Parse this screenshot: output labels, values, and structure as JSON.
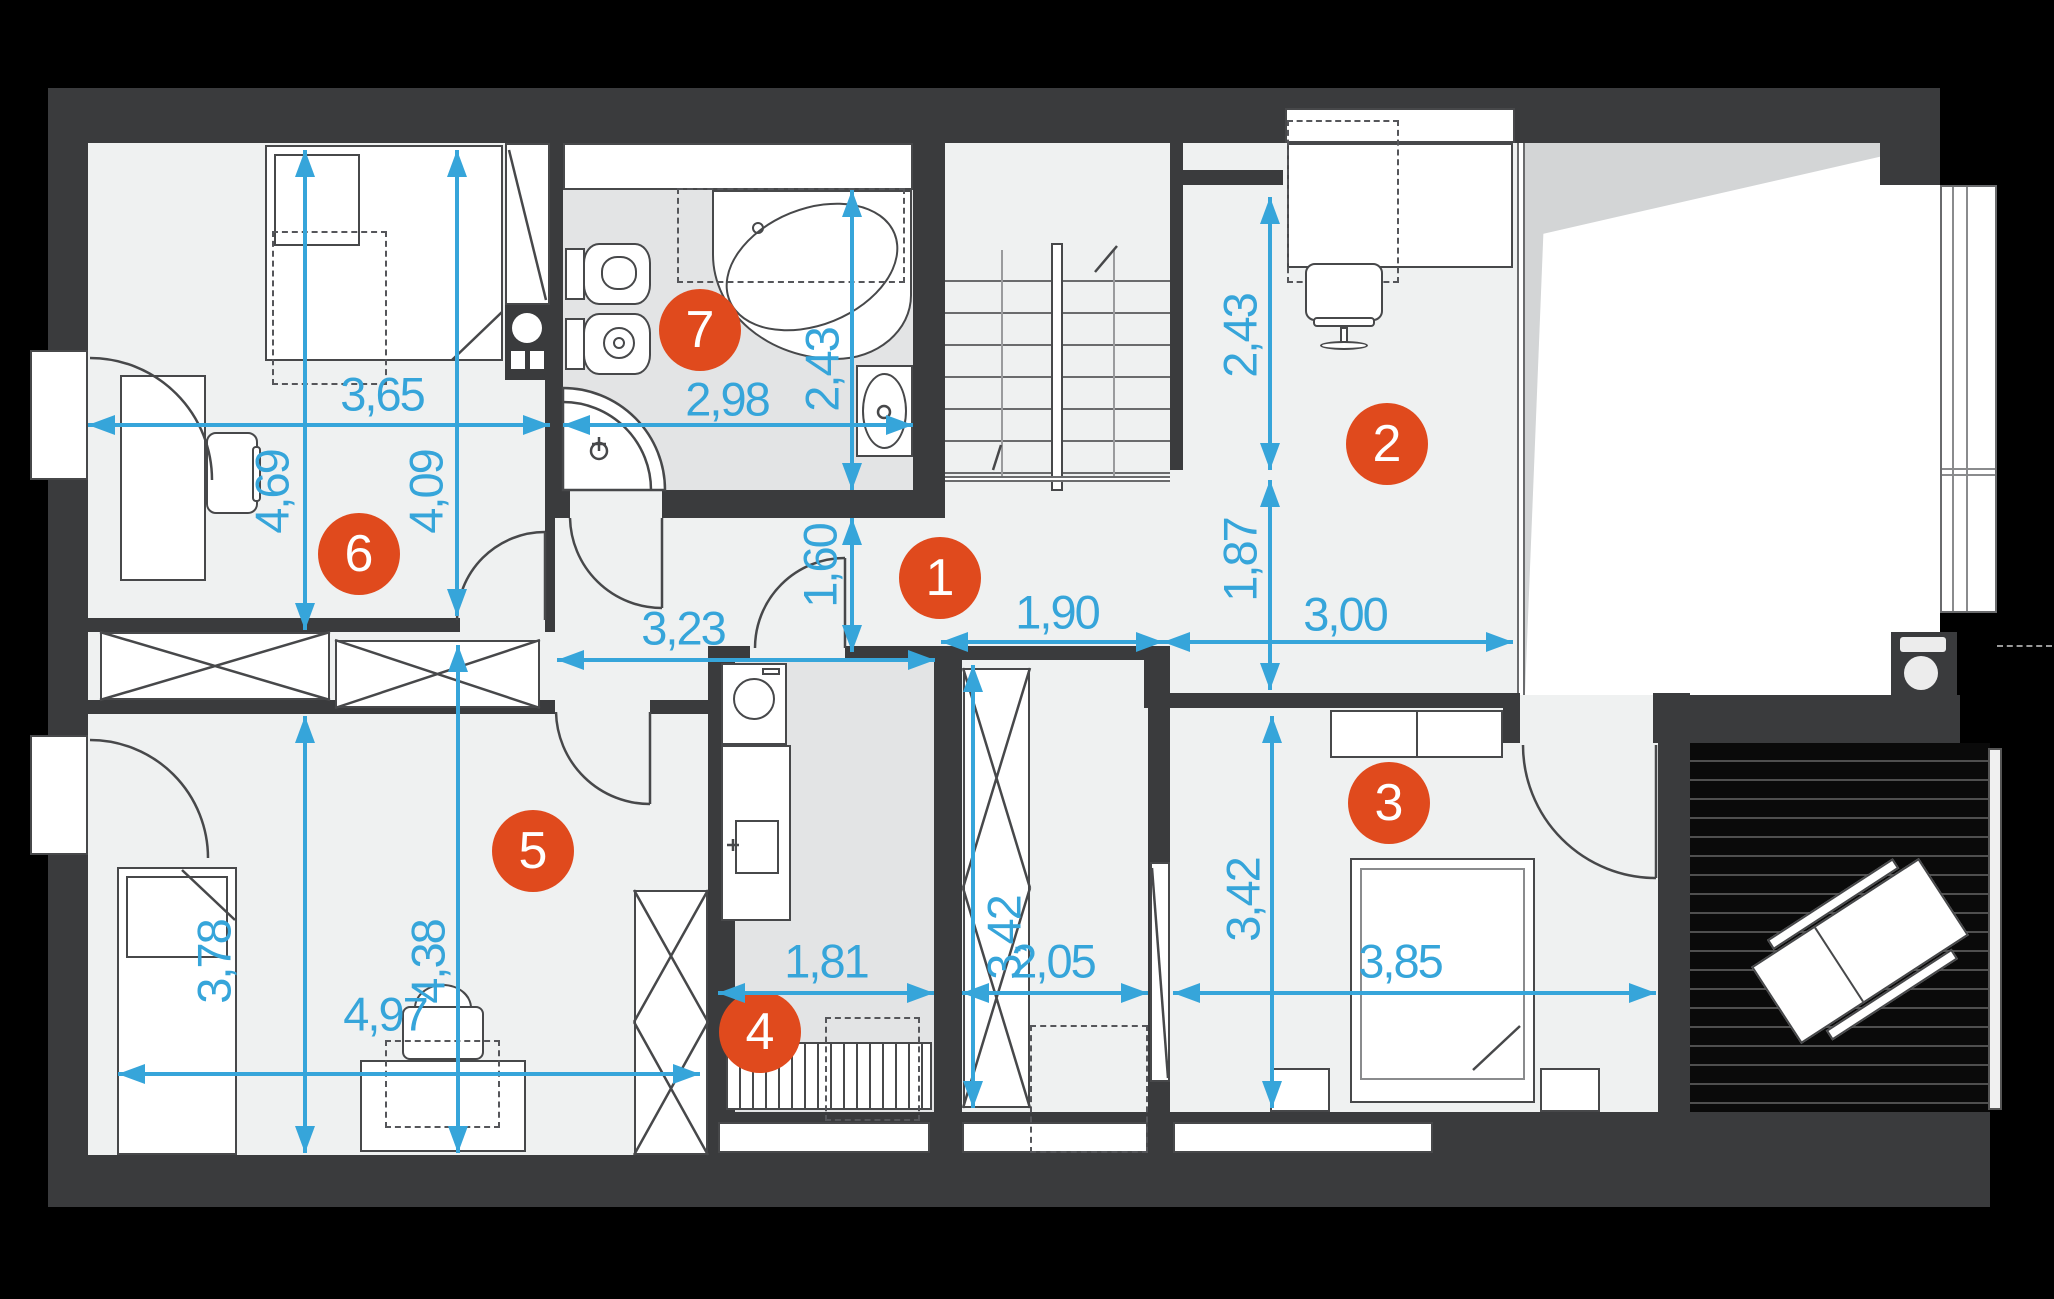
{
  "colors": {
    "dimension_blue": "#36a5da",
    "badge_orange": "#e04a1d",
    "wall_dark": "#3a3b3d",
    "floor_light": "#eff1f1",
    "floor_tile": "#e3e4e5",
    "background": "#000000"
  },
  "room_badges": [
    {
      "number": "1",
      "x": 940,
      "y": 578
    },
    {
      "number": "2",
      "x": 1387,
      "y": 444
    },
    {
      "number": "3",
      "x": 1389,
      "y": 803
    },
    {
      "number": "4",
      "x": 760,
      "y": 1032
    },
    {
      "number": "5",
      "x": 533,
      "y": 851
    },
    {
      "number": "6",
      "x": 359,
      "y": 554
    },
    {
      "number": "7",
      "x": 700,
      "y": 330
    }
  ],
  "dimensions": [
    {
      "label": "3,65",
      "orient": "h",
      "x1": 88,
      "x2": 550,
      "y": 425,
      "lx": 382,
      "ly": 394
    },
    {
      "label": "2,98",
      "orient": "h",
      "x1": 563,
      "x2": 913,
      "y": 425,
      "lx": 727,
      "ly": 399
    },
    {
      "label": "2,43",
      "orient": "v",
      "y1": 190,
      "y2": 490,
      "x": 852,
      "lx": 822,
      "ly": 370
    },
    {
      "label": "1,60",
      "orient": "v",
      "y1": 518,
      "y2": 652,
      "x": 852,
      "lx": 820,
      "ly": 566
    },
    {
      "label": "4,69",
      "orient": "v",
      "y1": 150,
      "y2": 630,
      "x": 305,
      "lx": 272,
      "ly": 492
    },
    {
      "label": "4,09",
      "orient": "v",
      "y1": 150,
      "y2": 616,
      "x": 457,
      "lx": 426,
      "ly": 492
    },
    {
      "label": "2,43",
      "orient": "v",
      "y1": 197,
      "y2": 470,
      "x": 1270,
      "lx": 1240,
      "ly": 336
    },
    {
      "label": "1,87",
      "orient": "v",
      "y1": 480,
      "y2": 690,
      "x": 1270,
      "lx": 1240,
      "ly": 560
    },
    {
      "label": "1,90",
      "orient": "h",
      "x1": 941,
      "x2": 1163,
      "y": 642,
      "lx": 1057,
      "ly": 612
    },
    {
      "label": "3,00",
      "orient": "h",
      "x1": 1163,
      "x2": 1513,
      "y": 642,
      "lx": 1345,
      "ly": 614
    },
    {
      "label": "3,23",
      "orient": "h",
      "x1": 557,
      "x2": 935,
      "y": 660,
      "lx": 683,
      "ly": 628
    },
    {
      "label": "3,78",
      "orient": "v",
      "y1": 716,
      "y2": 1153,
      "x": 305,
      "lx": 214,
      "ly": 962
    },
    {
      "label": "4,38",
      "orient": "v",
      "y1": 645,
      "y2": 1153,
      "x": 458,
      "lx": 428,
      "ly": 962
    },
    {
      "label": "4,97",
      "orient": "h",
      "x1": 118,
      "x2": 700,
      "y": 1074,
      "lx": 385,
      "ly": 1014
    },
    {
      "label": "1,81",
      "orient": "h",
      "x1": 718,
      "x2": 934,
      "y": 993,
      "lx": 826,
      "ly": 961
    },
    {
      "label": "3,42",
      "orient": "v",
      "y1": 665,
      "y2": 1108,
      "x": 973,
      "lx": 1004,
      "ly": 938
    },
    {
      "label": "2,05",
      "orient": "h",
      "x1": 962,
      "x2": 1148,
      "y": 993,
      "lx": 1053,
      "ly": 961
    },
    {
      "label": "3,42",
      "orient": "v",
      "y1": 716,
      "y2": 1108,
      "x": 1272,
      "lx": 1243,
      "ly": 900
    },
    {
      "label": "3,85",
      "orient": "h",
      "x1": 1173,
      "x2": 1656,
      "y": 993,
      "lx": 1400,
      "ly": 961
    }
  ]
}
